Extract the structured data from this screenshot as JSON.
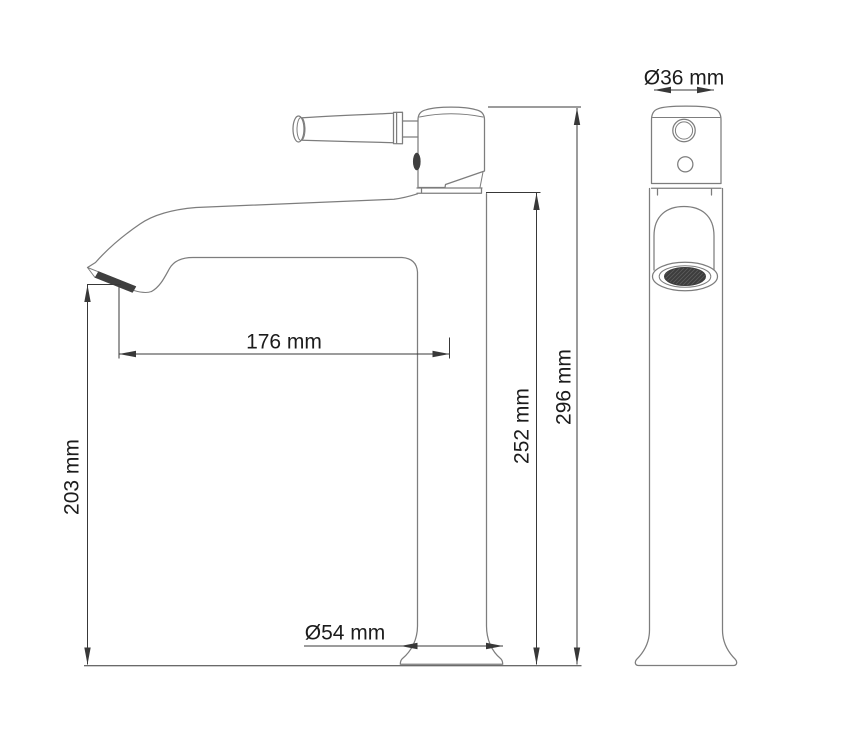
{
  "drawing_title": "faucet-technical-drawing",
  "colors": {
    "background": "#ffffff",
    "outline": "#7d7d7d",
    "dimension": "#383838",
    "text": "#1c1c1c",
    "aerator": "#3f3f3f"
  },
  "dimensions": {
    "spout_reach": {
      "label": "176 mm",
      "value_mm": 176
    },
    "outlet_height": {
      "label": "203 mm",
      "value_mm": 203
    },
    "body_height": {
      "label": "252 mm",
      "value_mm": 252
    },
    "total_height": {
      "label": "296 mm",
      "value_mm": 296
    },
    "base_diameter": {
      "label": "Ø54 mm",
      "value_mm": 54
    },
    "body_diameter": {
      "label": "Ø36 mm",
      "value_mm": 36
    }
  }
}
